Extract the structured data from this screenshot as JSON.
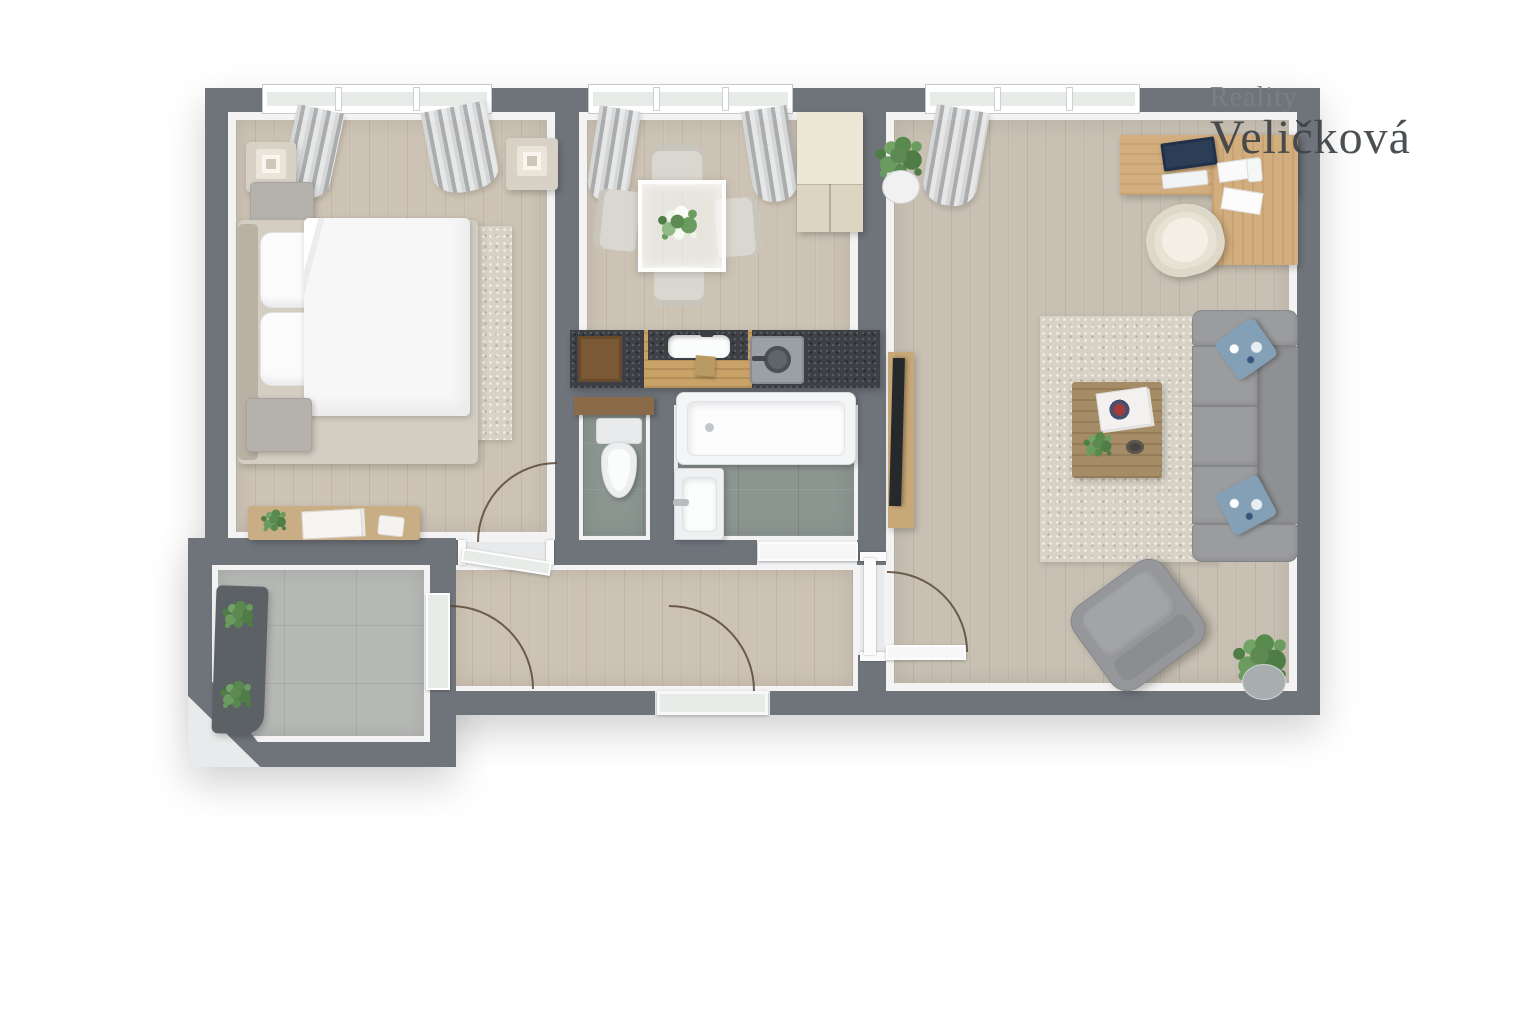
{
  "watermark": {
    "line1": "Reality",
    "line2": "Veličková"
  },
  "palette": {
    "canvas_bg": "#ffffff",
    "wall": "#6f747b",
    "wall_face": "#f3f3f4",
    "floor_wood": "#cdc3b5",
    "floor_wood_living": "#c8c0b3",
    "tile_bath": "#8c9691",
    "tile_balcony": "#b6b8b6",
    "glass": "#e8ece9",
    "curtain_gray": "#b9bbbd",
    "sofa": "#9b9c9e",
    "pillow_accent": "#84a0b6",
    "rug": "#d8d2c6",
    "wood_desk": "#d2ad7d",
    "wood_coffee_table": "#a58b66",
    "counter_dark": "#3c4045",
    "counter_wood": "#c9a268",
    "cabinet_cream": "#ece6d5",
    "bed_linen": "#f7f7f8",
    "furniture_beige": "#d7d1c6",
    "plant_green": "#5d8a52",
    "door_arc": "#5a4936",
    "watermark_light": "#7b8084",
    "watermark_dark": "#3e4347"
  },
  "rooms": {
    "bedroom": {
      "furniture": [
        "window",
        "curtains",
        "nightstand-with-lamp-left",
        "nightstand-with-lamp-right",
        "pouf-top",
        "bed-with-pillows-and-duvet",
        "pouf-bottom",
        "area-rug",
        "sideboard",
        "potted-plant",
        "picture-frames"
      ]
    },
    "kitchen_dining": {
      "furniture": [
        "window",
        "curtains",
        "dining-table-glass",
        "flower-centerpiece",
        "dining-chair-north",
        "dining-chair-south",
        "dining-chair-west",
        "dining-chair-east",
        "tall-cabinet",
        "kitchen-counter",
        "cutting-board",
        "sink",
        "stove-with-pan"
      ]
    },
    "wc": {
      "furniture": [
        "wood-shelf",
        "toilet"
      ]
    },
    "bathroom": {
      "furniture": [
        "bathtub",
        "washbasin",
        "door-leaf"
      ]
    },
    "living_room": {
      "furniture": [
        "window",
        "curtain",
        "corner-desk",
        "laptop",
        "keyboard",
        "papers",
        "desk-chair",
        "potted-plant-top",
        "tv-board",
        "tv",
        "area-rug",
        "coffee-table",
        "magazines",
        "bowl",
        "sofa",
        "cushion-top",
        "cushion-bottom",
        "armchair",
        "potted-plant-bottom"
      ]
    },
    "hallway": {
      "furniture": [
        "entrance-door",
        "door-swing-arcs"
      ]
    },
    "balcony": {
      "furniture": [
        "bench-planter",
        "potted-plant-1",
        "potted-plant-2",
        "glass-door"
      ]
    }
  }
}
